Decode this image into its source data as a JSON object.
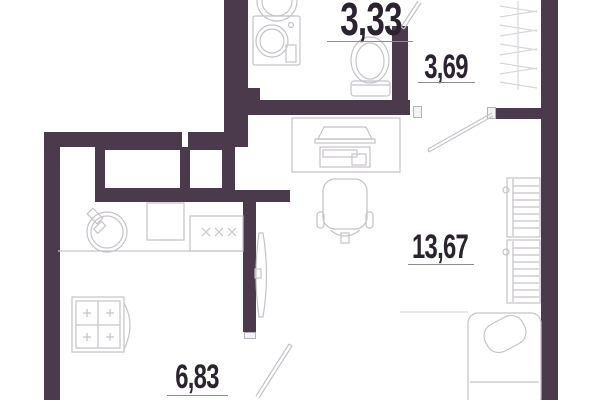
{
  "plan": {
    "type": "apartment-floor-plan",
    "rooms": [
      {
        "name": "bathroom",
        "area": "3,33"
      },
      {
        "name": "hallway",
        "area": "3,69"
      },
      {
        "name": "living-room",
        "area": "13,67"
      },
      {
        "name": "kitchen",
        "area": "6,83"
      }
    ],
    "colors": {
      "wall": "#4a3a4c",
      "fixture_line": "#c6c2c9",
      "text": "#2b2430",
      "background": "#ffffff"
    },
    "fixtures": [
      "bathroom-sink",
      "washing-machine",
      "toilet",
      "wardrobe-hangers",
      "door-swing",
      "desk",
      "monitor",
      "keyboard",
      "office-chair",
      "tv",
      "kitchen-sink",
      "fridge",
      "stove-burners",
      "cooktop",
      "radiator-upper",
      "radiator-lower",
      "bed",
      "pillow"
    ]
  }
}
